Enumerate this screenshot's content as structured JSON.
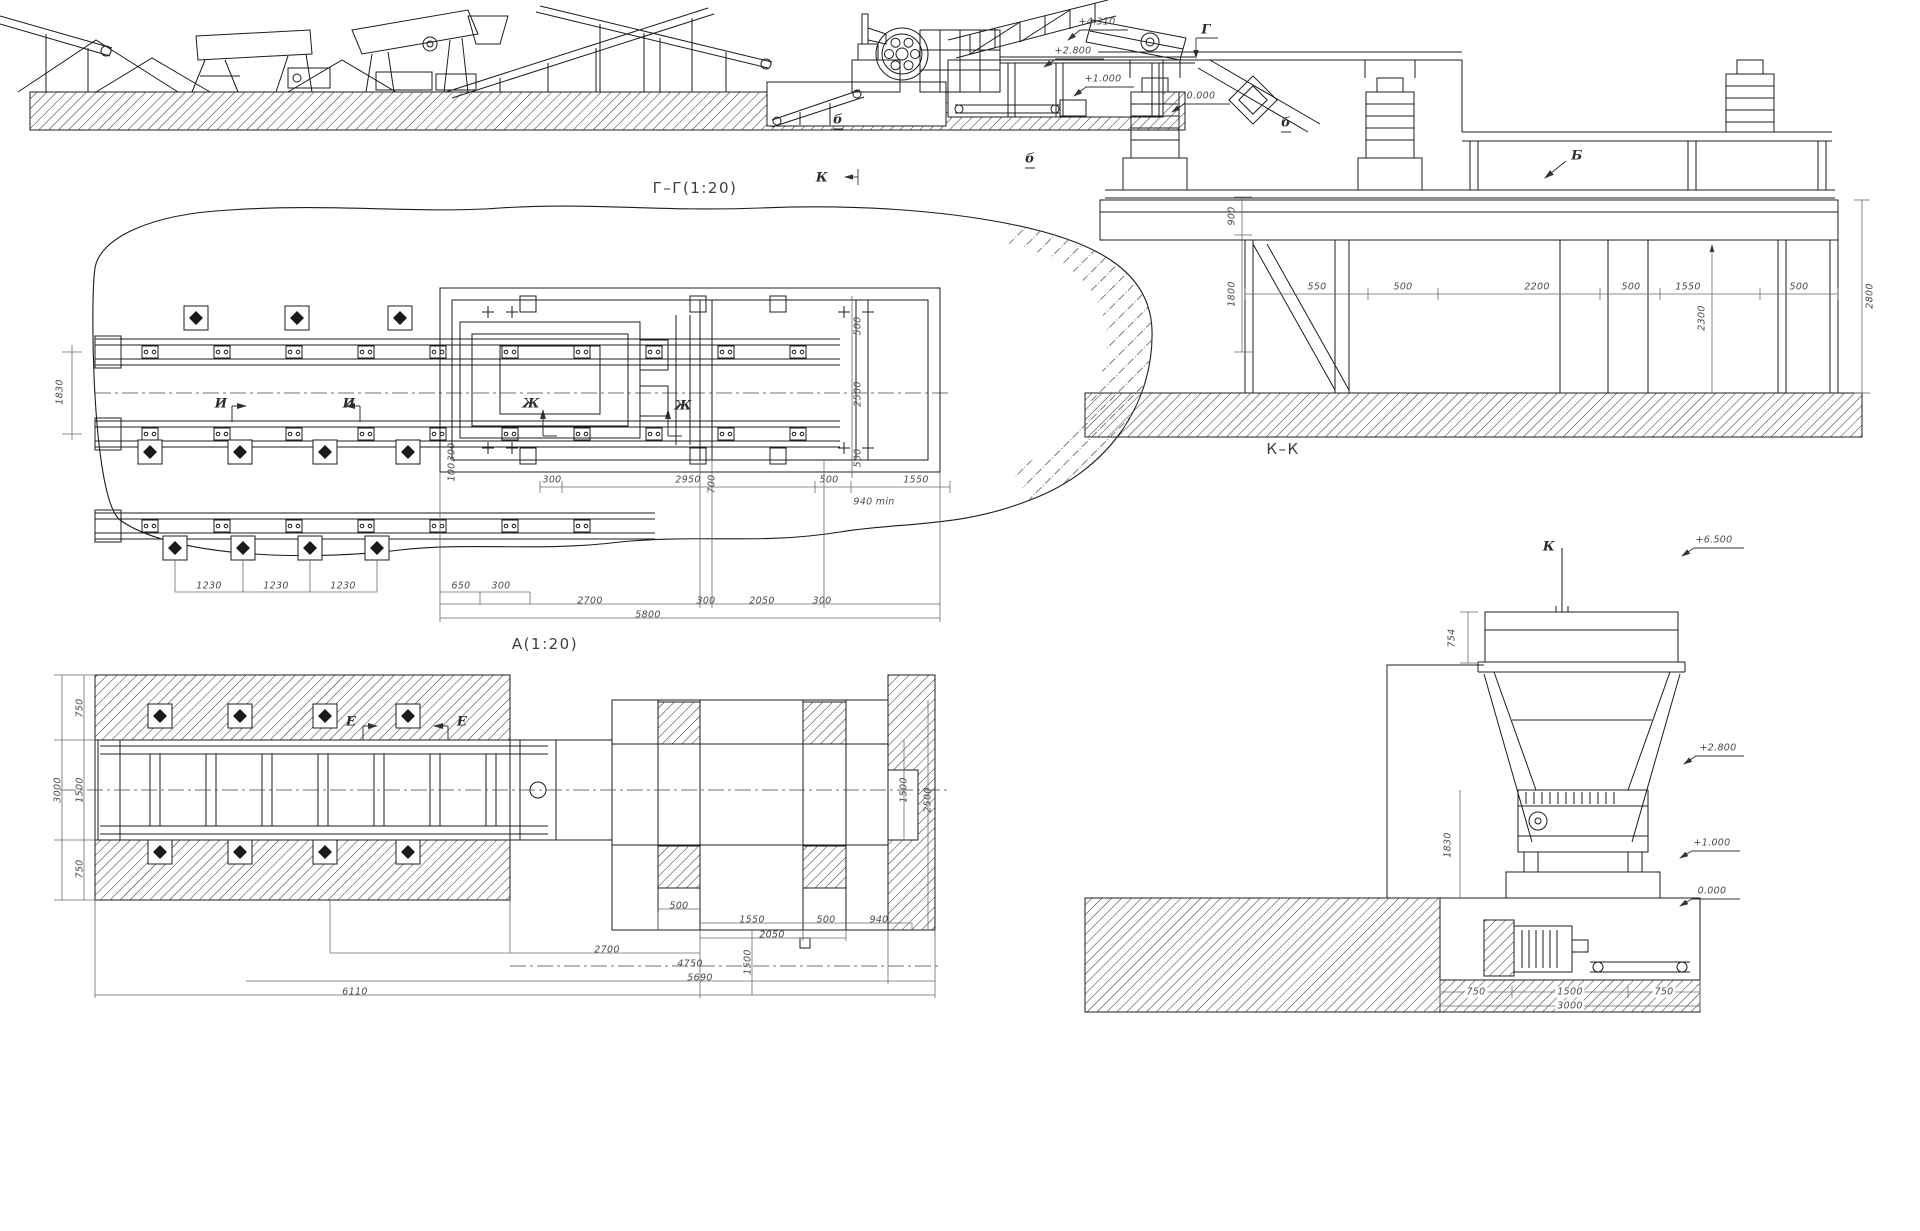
{
  "meta": {
    "ink": "#1c1c1c",
    "dim_color": "#4a4a4a",
    "background": "#ffffff"
  },
  "drawing": {
    "views": [
      "Г–Г(1:20)",
      "А(1:20)",
      "К–К"
    ],
    "elevation_marks": [
      "+4.310",
      "+2.800",
      "+1.000",
      "0.000",
      "+6.500",
      "+2.800",
      "+1.000",
      "0.000"
    ],
    "section_markers": [
      "Г",
      "К",
      "Б",
      "б",
      "И",
      "Ж",
      "Е"
    ]
  },
  "labels": [
    {
      "t": "Г–Г(1:20)",
      "x": 695,
      "y": 188,
      "c": "title",
      "n": "view-title-gg"
    },
    {
      "t": "А(1:20)",
      "x": 545,
      "y": 644,
      "c": "title",
      "n": "view-title-a"
    },
    {
      "t": "К–К",
      "x": 1283,
      "y": 449,
      "c": "title",
      "n": "view-title-kk"
    },
    {
      "t": "+4.310",
      "x": 1097,
      "y": 22,
      "n": "elevation-label"
    },
    {
      "t": "+2.800",
      "x": 1073,
      "y": 51,
      "n": "elevation-label"
    },
    {
      "t": "+1.000",
      "x": 1103,
      "y": 79,
      "n": "elevation-label"
    },
    {
      "t": "0.000",
      "x": 1201,
      "y": 96,
      "n": "elevation-label"
    },
    {
      "t": "Г",
      "x": 1206,
      "y": 30,
      "c": "marker",
      "n": "section-marker"
    },
    {
      "t": "К",
      "x": 822,
      "y": 178,
      "c": "marker",
      "n": "section-marker"
    },
    {
      "t": "б",
      "x": 838,
      "y": 121,
      "c": "marker u",
      "n": "callout"
    },
    {
      "t": "б",
      "x": 1030,
      "y": 160,
      "c": "marker u",
      "n": "callout"
    },
    {
      "t": "б",
      "x": 1286,
      "y": 124,
      "c": "marker u",
      "n": "callout"
    },
    {
      "t": "Б",
      "x": 1577,
      "y": 156,
      "c": "marker",
      "n": "section-marker"
    },
    {
      "t": "550",
      "x": 1317,
      "y": 287,
      "n": "dim-label"
    },
    {
      "t": "500",
      "x": 1403,
      "y": 287,
      "n": "dim-label"
    },
    {
      "t": "2200",
      "x": 1537,
      "y": 287,
      "n": "dim-label"
    },
    {
      "t": "500",
      "x": 1631,
      "y": 287,
      "n": "dim-label"
    },
    {
      "t": "1550",
      "x": 1688,
      "y": 287,
      "n": "dim-label"
    },
    {
      "t": "500",
      "x": 1799,
      "y": 287,
      "n": "dim-label"
    },
    {
      "t": "900",
      "x": 1232,
      "y": 216,
      "r": 1,
      "n": "dim-label"
    },
    {
      "t": "1800",
      "x": 1232,
      "y": 294,
      "r": 1,
      "n": "dim-label"
    },
    {
      "t": "2300",
      "x": 1702,
      "y": 318,
      "r": 1,
      "n": "dim-label"
    },
    {
      "t": "2800",
      "x": 1870,
      "y": 296,
      "r": 1,
      "n": "dim-label"
    },
    {
      "t": "И",
      "x": 221,
      "y": 404,
      "c": "marker",
      "n": "section-marker"
    },
    {
      "t": "И",
      "x": 349,
      "y": 404,
      "c": "marker",
      "n": "section-marker"
    },
    {
      "t": "Ж",
      "x": 531,
      "y": 404,
      "c": "marker",
      "n": "section-marker"
    },
    {
      "t": "Ж",
      "x": 683,
      "y": 406,
      "c": "marker",
      "n": "section-marker"
    },
    {
      "t": "300",
      "x": 552,
      "y": 480,
      "n": "dim-label"
    },
    {
      "t": "2950",
      "x": 688,
      "y": 480,
      "n": "dim-label"
    },
    {
      "t": "500",
      "x": 829,
      "y": 480,
      "n": "dim-label"
    },
    {
      "t": "1550",
      "x": 916,
      "y": 480,
      "n": "dim-label"
    },
    {
      "t": "940 min",
      "x": 874,
      "y": 502,
      "n": "dim-label"
    },
    {
      "t": "1830",
      "x": 60,
      "y": 392,
      "r": 1,
      "n": "dim-label"
    },
    {
      "t": "500",
      "x": 858,
      "y": 326,
      "r": 1,
      "n": "dim-label"
    },
    {
      "t": "2500",
      "x": 858,
      "y": 394,
      "r": 1,
      "n": "dim-label"
    },
    {
      "t": "500",
      "x": 858,
      "y": 458,
      "r": 1,
      "n": "dim-label"
    },
    {
      "t": "700",
      "x": 712,
      "y": 484,
      "r": 1,
      "n": "dim-label"
    },
    {
      "t": "300",
      "x": 452,
      "y": 452,
      "r": 1,
      "n": "dim-label"
    },
    {
      "t": "100",
      "x": 452,
      "y": 472,
      "r": 1,
      "n": "dim-label"
    },
    {
      "t": "1230",
      "x": 209,
      "y": 586,
      "n": "dim-label"
    },
    {
      "t": "1230",
      "x": 276,
      "y": 586,
      "n": "dim-label"
    },
    {
      "t": "1230",
      "x": 343,
      "y": 586,
      "n": "dim-label"
    },
    {
      "t": "650",
      "x": 461,
      "y": 586,
      "n": "dim-label"
    },
    {
      "t": "300",
      "x": 501,
      "y": 586,
      "n": "dim-label"
    },
    {
      "t": "2700",
      "x": 590,
      "y": 601,
      "n": "dim-label"
    },
    {
      "t": "300",
      "x": 706,
      "y": 601,
      "n": "dim-label"
    },
    {
      "t": "2050",
      "x": 762,
      "y": 601,
      "n": "dim-label"
    },
    {
      "t": "300",
      "x": 822,
      "y": 601,
      "n": "dim-label"
    },
    {
      "t": "5800",
      "x": 648,
      "y": 615,
      "n": "dim-label"
    },
    {
      "t": "Е",
      "x": 351,
      "y": 722,
      "c": "marker",
      "n": "section-marker"
    },
    {
      "t": "Е",
      "x": 462,
      "y": 722,
      "c": "marker",
      "n": "section-marker"
    },
    {
      "t": "3000",
      "x": 58,
      "y": 790,
      "r": 1,
      "n": "dim-label"
    },
    {
      "t": "750",
      "x": 80,
      "y": 708,
      "r": 1,
      "n": "dim-label"
    },
    {
      "t": "1500",
      "x": 80,
      "y": 790,
      "r": 1,
      "n": "dim-label"
    },
    {
      "t": "750",
      "x": 80,
      "y": 869,
      "r": 1,
      "n": "dim-label"
    },
    {
      "t": "1500",
      "x": 904,
      "y": 790,
      "r": 1,
      "n": "dim-label"
    },
    {
      "t": "2500",
      "x": 928,
      "y": 800,
      "r": 1,
      "n": "dim-label"
    },
    {
      "t": "1500",
      "x": 748,
      "y": 962,
      "r": 1,
      "n": "dim-label"
    },
    {
      "t": "500",
      "x": 679,
      "y": 906,
      "n": "dim-label"
    },
    {
      "t": "1550",
      "x": 752,
      "y": 920,
      "n": "dim-label"
    },
    {
      "t": "500",
      "x": 826,
      "y": 920,
      "n": "dim-label"
    },
    {
      "t": "940",
      "x": 879,
      "y": 920,
      "n": "dim-label"
    },
    {
      "t": "2050",
      "x": 772,
      "y": 935,
      "n": "dim-label"
    },
    {
      "t": "2700",
      "x": 607,
      "y": 950,
      "n": "dim-label"
    },
    {
      "t": "4750",
      "x": 690,
      "y": 964,
      "n": "dim-label"
    },
    {
      "t": "5690",
      "x": 700,
      "y": 978,
      "n": "dim-label"
    },
    {
      "t": "6110",
      "x": 355,
      "y": 992,
      "n": "dim-label"
    },
    {
      "t": "754",
      "x": 1452,
      "y": 638,
      "r": 1,
      "n": "dim-label"
    },
    {
      "t": "1830",
      "x": 1448,
      "y": 845,
      "r": 1,
      "n": "dim-label"
    },
    {
      "t": "К",
      "x": 1549,
      "y": 547,
      "c": "marker",
      "n": "section-marker"
    },
    {
      "t": "+6.500",
      "x": 1714,
      "y": 540,
      "n": "elevation-label"
    },
    {
      "t": "+2.800",
      "x": 1718,
      "y": 748,
      "n": "elevation-label"
    },
    {
      "t": "+1.000",
      "x": 1712,
      "y": 843,
      "n": "elevation-label"
    },
    {
      "t": "0.000",
      "x": 1712,
      "y": 891,
      "n": "elevation-label"
    },
    {
      "t": "750",
      "x": 1476,
      "y": 992,
      "c": "w",
      "n": "dim-label"
    },
    {
      "t": "1500",
      "x": 1570,
      "y": 992,
      "c": "w",
      "n": "dim-label"
    },
    {
      "t": "750",
      "x": 1664,
      "y": 992,
      "c": "w",
      "n": "dim-label"
    },
    {
      "t": "3000",
      "x": 1570,
      "y": 1006,
      "c": "w",
      "n": "dim-label"
    }
  ]
}
